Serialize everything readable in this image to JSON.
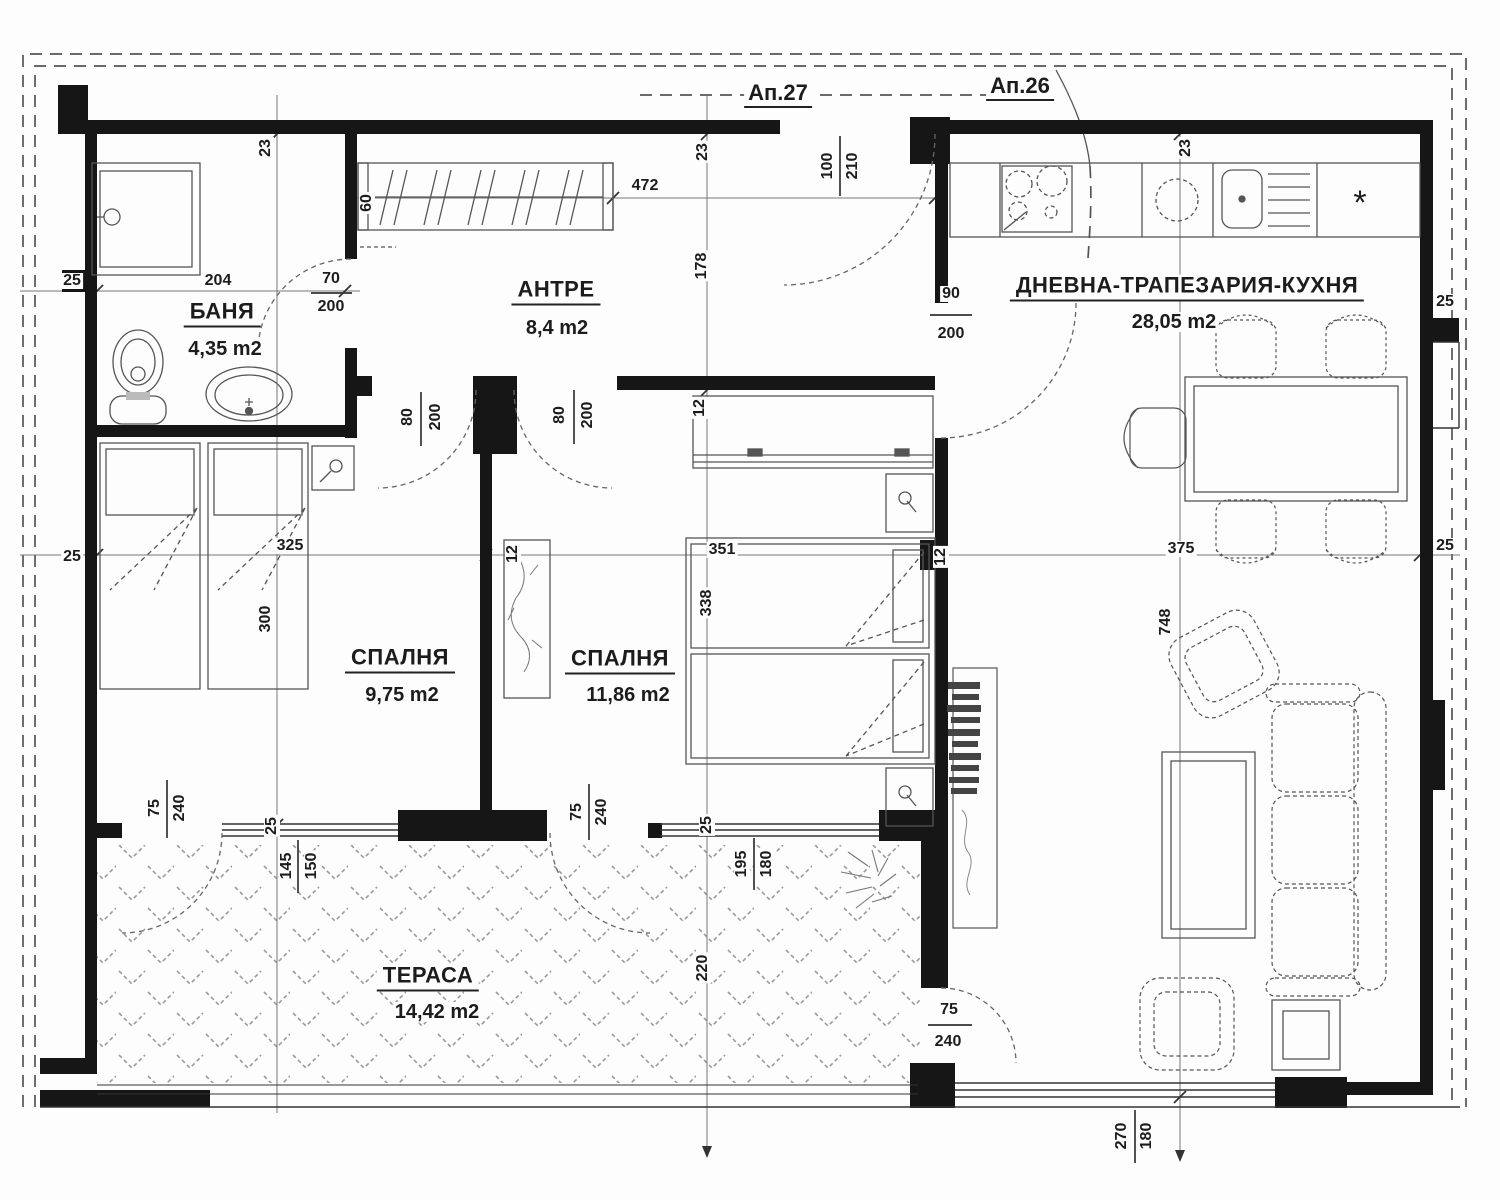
{
  "apartments": [
    {
      "label": "Ап.27"
    },
    {
      "label": "Ап.26"
    }
  ],
  "rooms": [
    {
      "name": "БАНЯ",
      "area": "4,35 m2"
    },
    {
      "name": "АНТРЕ",
      "area": "8,4 m2"
    },
    {
      "name": "СПАЛНЯ",
      "area": "9,75 m2"
    },
    {
      "name": "СПАЛНЯ",
      "area": "11,86 m2"
    },
    {
      "name": "ДНЕВНА-ТРАПЕЗАРИЯ-КУХНЯ",
      "area": "28,05 m2"
    },
    {
      "name": "ТЕРАСА",
      "area": "14,42 m2"
    }
  ],
  "dims": {
    "n12": "12",
    "n23": "23",
    "n25": "25",
    "n60": "60",
    "n70": "70",
    "n75": "75",
    "n80": "80",
    "n90": "90",
    "n100": "100",
    "n145": "145",
    "n150": "150",
    "n178": "178",
    "n180": "180",
    "n195": "195",
    "n200": "200",
    "n204": "204",
    "n210": "210",
    "n220": "220",
    "n240": "240",
    "n270": "270",
    "n300": "300",
    "n325": "325",
    "n338": "338",
    "n351": "351",
    "n375": "375",
    "n472": "472",
    "n748": "748"
  },
  "symbols": {
    "boiler": "*"
  }
}
